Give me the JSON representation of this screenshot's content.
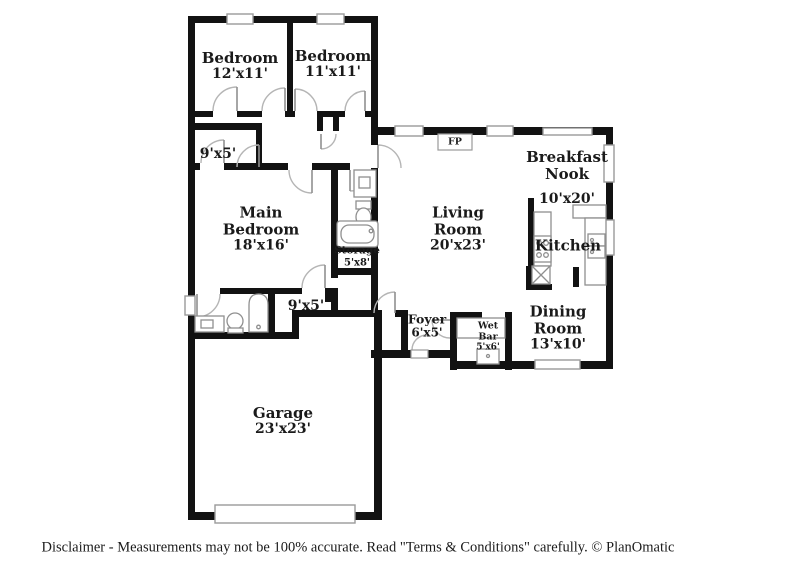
{
  "plan": {
    "rooms": {
      "bedroom1": {
        "name": "Bedroom",
        "dims": "12'x11'"
      },
      "bedroom2": {
        "name": "Bedroom",
        "dims": "11'x11'"
      },
      "hall_upper": {
        "dims": "9'x5'"
      },
      "main_bedroom": {
        "name": "Main Bedroom",
        "dims": "18'x16'"
      },
      "storage": {
        "name": "Storage",
        "dims": "5'x8'"
      },
      "hall_lower": {
        "dims": "9'x5'"
      },
      "living_room": {
        "name": "Living Room",
        "dims": "20'x23'"
      },
      "breakfast_nook": {
        "name": "Breakfast Nook",
        "dims": "10'x20'"
      },
      "kitchen": {
        "name": "Kitchen"
      },
      "foyer": {
        "name": "Foyer",
        "dims": "6'x5'"
      },
      "wet_bar": {
        "name": "Wet Bar",
        "dims": "5'x6'"
      },
      "dining_room": {
        "name": "Dining Room",
        "dims": "13'x10'"
      },
      "garage": {
        "name": "Garage",
        "dims": "23'x23'"
      }
    },
    "fireplace": {
      "label": "FP"
    },
    "colors": {
      "wall": "#121212",
      "window_trim": "#9a9a9a",
      "fixture_line": "#8f8f8f",
      "door_arc": "#b5b5b5",
      "label_text": "#1a1a1a",
      "background": "#ffffff"
    }
  },
  "footer": {
    "disclaimer": "Disclaimer - Measurements may not be 100% accurate. Read \"Terms & Conditions\" carefully. © PlanOmatic"
  }
}
